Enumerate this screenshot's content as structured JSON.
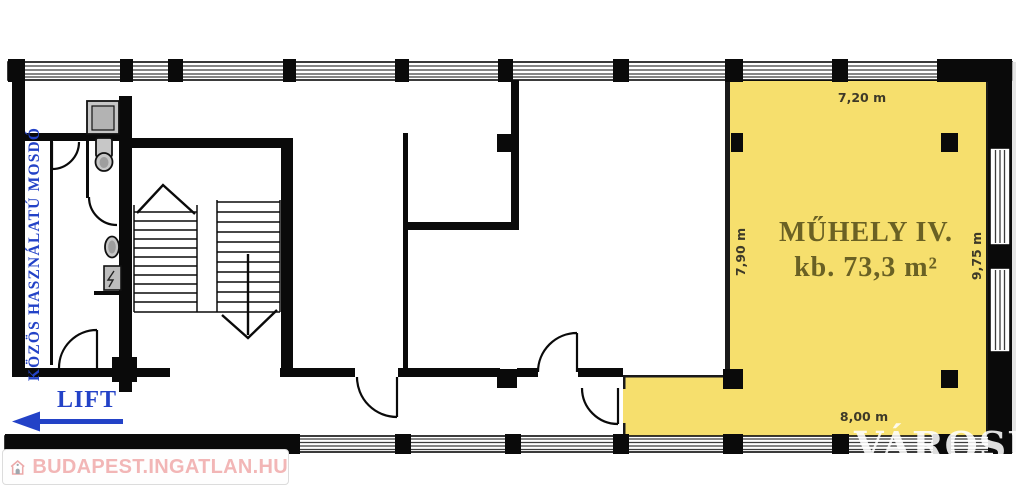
{
  "plan": {
    "room": {
      "name": "MŰHELY IV.",
      "area": "kb. 73,3 m²"
    },
    "dimensions": {
      "top": "7,20 m",
      "left": "7,90 m",
      "right": "9,75 m",
      "bottom": "8,00 m"
    },
    "lift_label": "LIFT",
    "washroom_label": "KÖZÖS HASZNÁLATÚ MOSDÓ",
    "colors": {
      "highlight_yellow": "#F6DF6D",
      "room_text": "#6A6124",
      "dimension_text": "#3E3A28",
      "label_blue": "#2342C7",
      "wall_black": "#0A0A0A",
      "watermark_pink": "#F2B6B6"
    }
  },
  "watermarks": {
    "portal_text": "BUDAPEST.INGATLAN.HU",
    "agency_text": "VÁROSI"
  }
}
